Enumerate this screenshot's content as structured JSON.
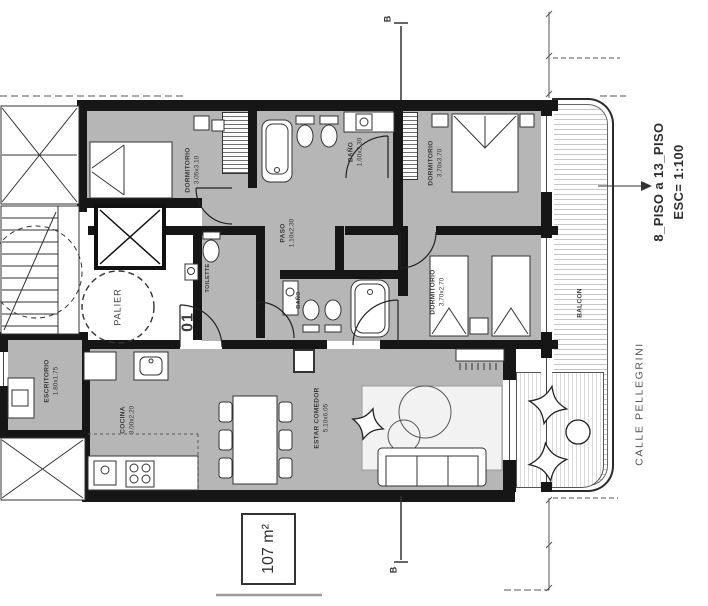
{
  "plan": {
    "unit": "01",
    "area": "107 m²",
    "scale_title": "8_PISO a 13_PISO",
    "scale": "ESC= 1:100",
    "street": "CALLE PELLEGRINI",
    "section": "B",
    "palier": "PALIER",
    "rooms": {
      "dorm1": {
        "name": "DORMITORIO",
        "dims": "3.05x3.10"
      },
      "bano1": {
        "name": "BAÑO",
        "dims": "1.60x2.30"
      },
      "dorm2": {
        "name": "DORMITORIO",
        "dims": "3.70x3.70"
      },
      "paso": {
        "name": "PASO",
        "dims": "1.10x2.30"
      },
      "toilette": {
        "name": "TOILETTE"
      },
      "bano2": {
        "name": "BAÑO"
      },
      "dorm3": {
        "name": "DORMITORIO",
        "dims": "3.70x2.70"
      },
      "escritorio": {
        "name": "ESCRITORIO",
        "dims": "1.80x1.75"
      },
      "cocina": {
        "name": "COCINA",
        "dims": "3.00x2.20"
      },
      "estar": {
        "name": "ESTAR COMEDOR",
        "dims": "5.10x6.05"
      },
      "balcon": {
        "name": "BALCON"
      }
    },
    "colors": {
      "floor": "#b6b6b6",
      "wall": "#161616"
    }
  }
}
